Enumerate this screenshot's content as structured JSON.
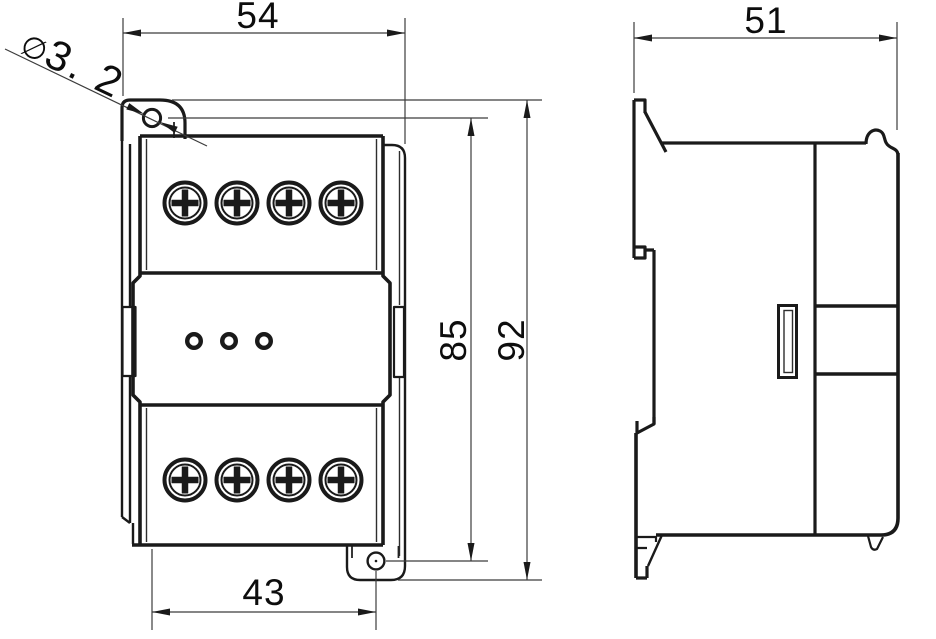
{
  "dimensions": {
    "front_width_top_mm": "54",
    "front_mounting_hole_span_mm": "43",
    "front_hole_span_vertical_mm": "85",
    "front_overall_height_mm": "92",
    "mounting_hole_diameter_symbol": "∅",
    "mounting_hole_diameter_value": "3. 2",
    "side_depth_mm": "51"
  },
  "features": {
    "top_terminal_screws": 4,
    "bottom_terminal_screws": 4,
    "indicator_holes": 3,
    "mounting_holes": 2
  },
  "colors": {
    "background": "#ffffff",
    "line": "#1a1a1a",
    "dim_line": "#3c3c3c"
  }
}
